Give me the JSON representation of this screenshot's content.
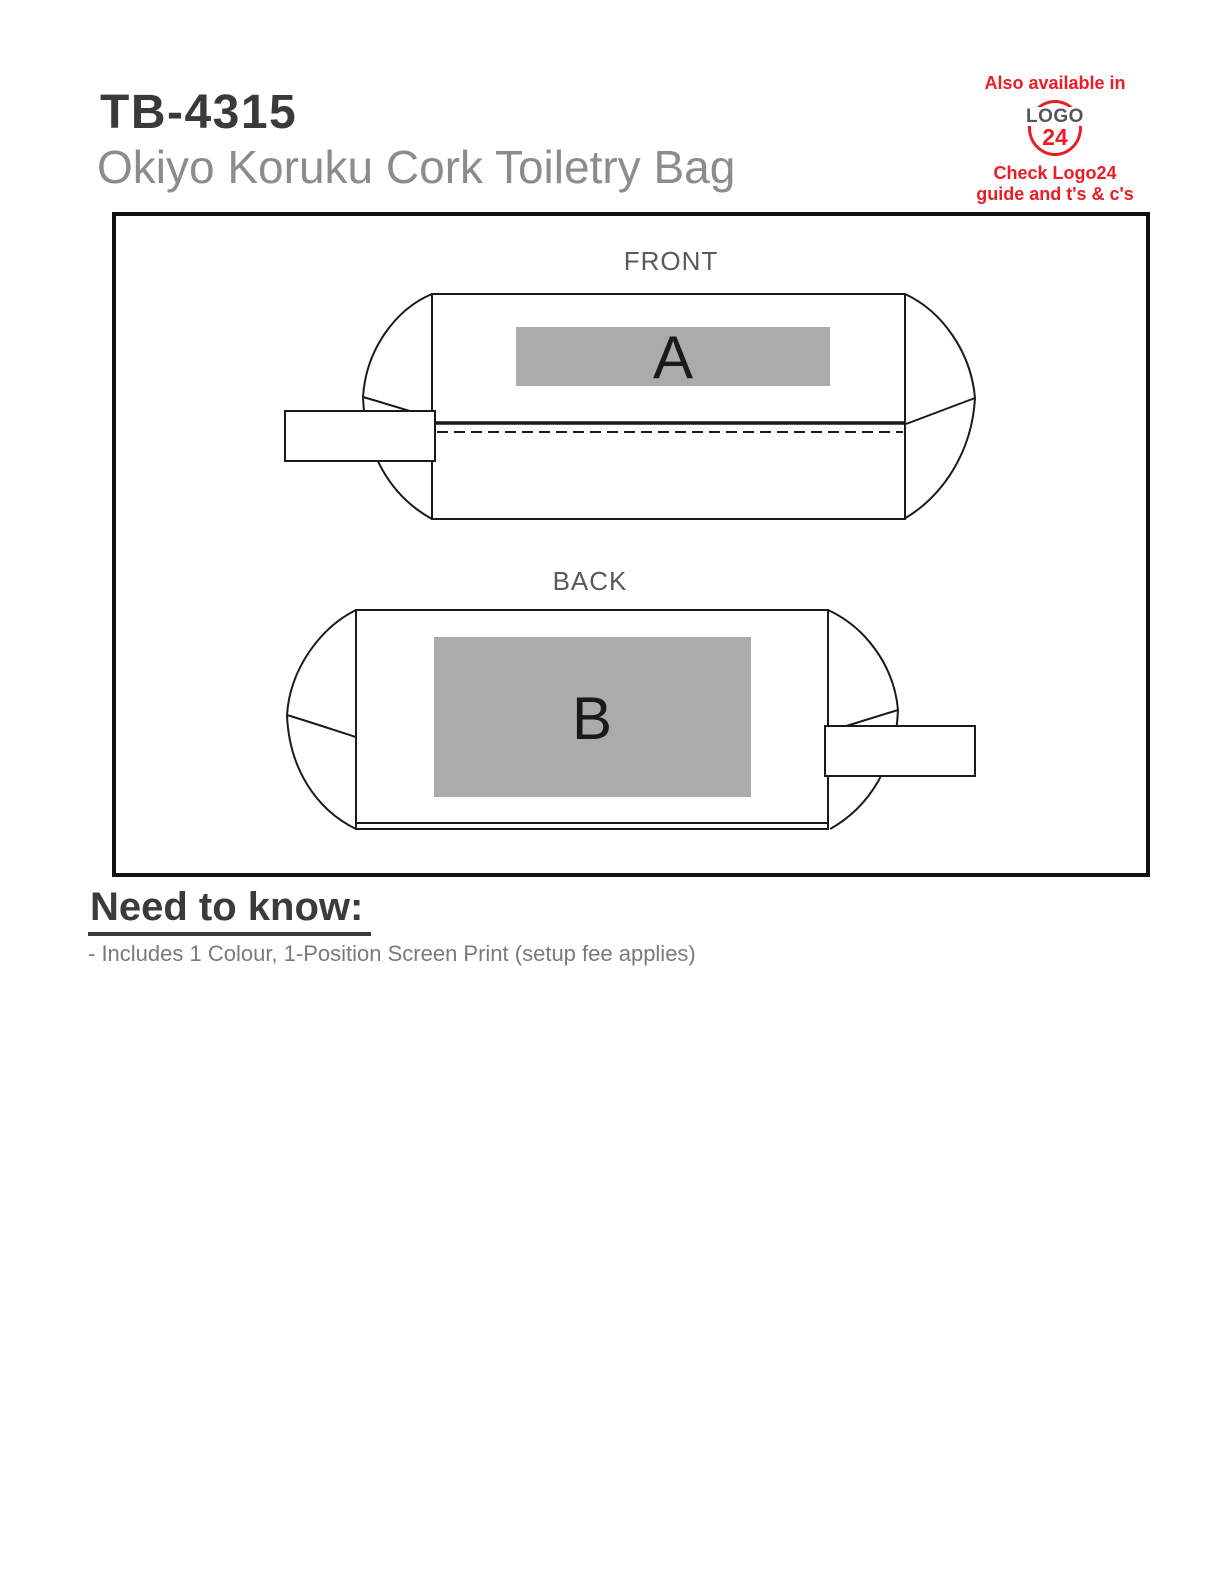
{
  "header": {
    "product_code": "TB-4315",
    "product_name": "Okiyo Koruku Cork Toiletry Bag"
  },
  "logo24": {
    "available_text": "Also available in",
    "logo_text": "LOGO",
    "logo_number": "24",
    "check_line1": "Check Logo24",
    "check_line2": "guide and t's & c's"
  },
  "diagram": {
    "front_label": "FRONT",
    "back_label": "BACK",
    "front_print_code": "A",
    "back_print_code": "B"
  },
  "need_to_know": {
    "heading": "Need to know:",
    "items": [
      "- Includes 1 Colour, 1-Position Screen Print (setup fee applies)"
    ]
  },
  "colors": {
    "accent_red": "#ec1c24",
    "print_area_gray": "#ababab",
    "outline_black": "#1a1a1a",
    "heading_dark": "#3a3a3a",
    "subtitle_gray": "#8c8c8c",
    "body_text_gray": "#7a7a7a",
    "view_label_gray": "#595959"
  }
}
